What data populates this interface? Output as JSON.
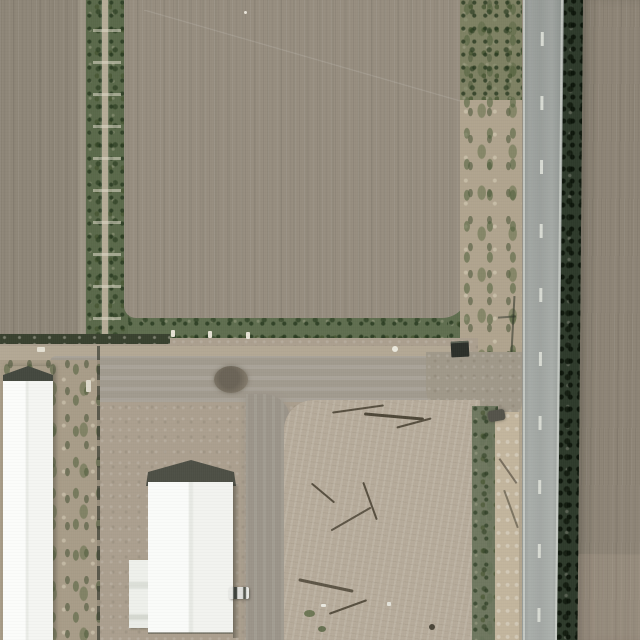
{
  "meta": {
    "type": "aerial-photograph",
    "description": "Aerial top-down view of farmland: large plowed brown fields, a vertical irrigation ditch with green vegetation, a north-south two-lane asphalt road with dashed centerline and dark hedgerow on its east side, white farm buildings and a gravel yard with a scraped dirt pad in the lower left quadrant."
  },
  "palette": {
    "field-left": "#8e8678",
    "field-central": "#968d7f",
    "field-right": "#8d8476",
    "ditch-green": "#5a694a",
    "ditch-path": "#b5ac97",
    "border-green": "#5f6e4f",
    "hedge-dark": "#2e3a2b",
    "road-asphalt": "#9da29e",
    "road-line": "#ced2cc",
    "roadside-tan": "#b0a48e",
    "gravel": "#a19a8e",
    "yard-dirt": "#ab9f8e",
    "pad-dirt": "#b6ab9a",
    "sand": "#c2b59d",
    "building-white": "#f6f7f4",
    "gable-dark": "#44483f",
    "ditchline-dark": "#39412f",
    "twig-dark": "#574f40"
  },
  "scene": {
    "regions": {
      "field_left": {
        "description": "Plowed field, upper left"
      },
      "ditch": {
        "description": "Irrigation ditch with vegetation and center access path, check gates at intervals"
      },
      "field_central": {
        "description": "Large plowed field, center, vertical plow rows"
      },
      "border_green": {
        "description": "Green vegetated border along south edge of central field with white standpipes"
      },
      "roadside_left": {
        "description": "Weedy tan shoulder strip west of road"
      },
      "road": {
        "description": "Two-lane asphalt road, white edge lines and dashed centerline"
      },
      "hedge": {
        "description": "Dark hedgerow / windbreak east of road"
      },
      "field_right": {
        "description": "Plowed field east of road"
      },
      "gravel_road": {
        "description": "Gravel farm road running east-west to the paved road"
      },
      "pad": {
        "description": "Scraped light dirt pad with branch debris"
      },
      "barn": {
        "description": "Long white-roofed barn with dark gable cap, west side"
      },
      "building": {
        "description": "White gable-roof farm building, lower center"
      },
      "shed": {
        "description": "Small white shed beside building"
      },
      "truck": {
        "description": "Small white pickup truck parked east of building"
      },
      "mound": {
        "description": "Dark round mound / brush pile on gravel road"
      },
      "trailer": {
        "description": "Dark trailer parked at field corner near road"
      }
    }
  }
}
